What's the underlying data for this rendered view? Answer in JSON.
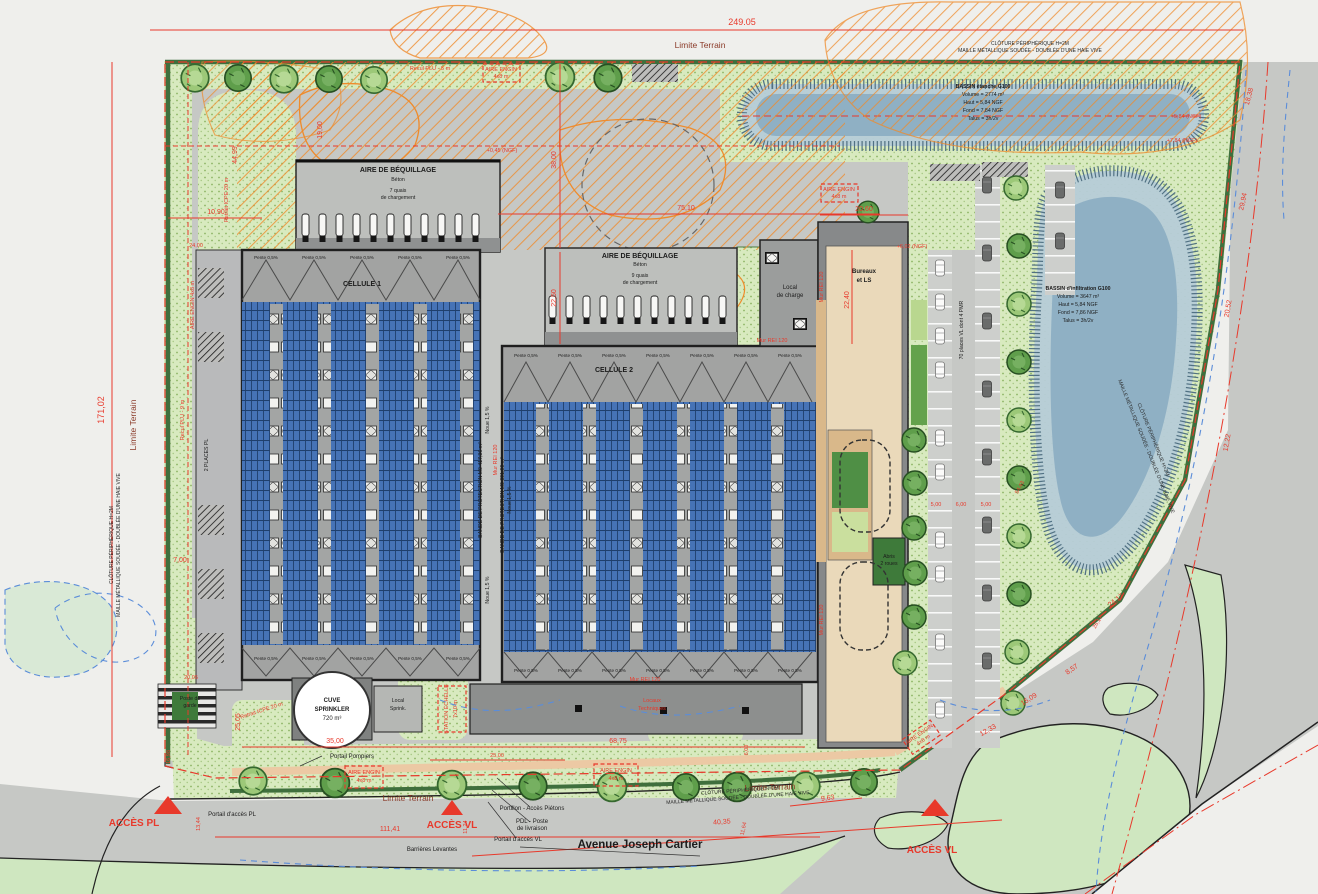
{
  "title": "Plan de masse - Avenue Joseph Cartier",
  "colors": {
    "dim_red": "#e8392b",
    "panel_blue": "#4673b6",
    "landscape_green": "#d8eabf",
    "hedge_green": "#3f6f3d",
    "water_blue": "#8fb0c4",
    "hatch_orange": "#ef8b2b",
    "road_gray": "#c6c8c5"
  },
  "labels": {
    "limite": "Limite Terrain",
    "cloture1": "CLÔTURE PÉRIPHÉRIQUE H=2M",
    "cloture2": "MAILLE MÉTALLIQUE SOUDÉE - DOUBLÉE D'UNE HAIE VIVE",
    "recul5": "Recul PLU - 5 m",
    "recul9": "Recul PLU - 9 m",
    "retrait": "Retrait ICPE 20 m",
    "aire_beq": "AIRE DE BÉQUILLAGE",
    "beton": "Béton",
    "quais7": "7 quais",
    "quais9": "9 quais",
    "charg": "de chargement",
    "cellule1": "CELLULE 1",
    "cellule2": "CELLULE 2",
    "pente": "Pente 0,5%",
    "noue": "Noue 1,5 %",
    "bande1": "BANDE DE PROTECTION M0 417,36 m²",
    "bande2": "BANDE DE PROTECTION M0 391,00 m²",
    "mur": "Mur REI 120",
    "lc1": "Local",
    "lc2": "de charge",
    "b1": "Bureaux",
    "b2": "et LS",
    "places70": "70 places VL dont 4 PMR",
    "places_pl": "2 PLACES PL",
    "ab1": "Abris",
    "ab2": "2 roues",
    "engin1": "AIRE ENGIN",
    "engin2": "4x8 m",
    "engin_v": "AIRE ENGIN 4x8 m",
    "cuve1": "CUVE",
    "cuve2": "SPRINKLER",
    "cuve3": "720 m³",
    "sprink1": "Local",
    "sprink2": "Sprink.",
    "station1": "STATION ÉCHELLE",
    "station2": "7x10 m",
    "locaux1": "Locaux",
    "locaux2": "Techniques",
    "p_pompiers": "Portail Pompiers",
    "p_pl": "Portail d'accès PL",
    "p_vl": "Portail d'accès VL",
    "portillon": "Portillon - Accès Piétons",
    "pdl1": "PDL - Poste",
    "pdl2": "de livraison",
    "barrieres": "Barrières Levantes",
    "garde1": "Poste de",
    "garde2": "garde",
    "acces_pl": "ACCÈS PL",
    "acces_vl": "ACCÈS VL",
    "avenue": "Avenue Joseph Cartier",
    "ngf045": "+0,45 (NGF)",
    "ngf584": "+5,84 (NGF)",
    "ngf784": "+7,84 (NGF)",
    "ngf602": "+6,02 (NGF)"
  },
  "bassins": {
    "top": {
      "title": "BASSIN étanche G100",
      "lines": [
        "Volume = 2774 m³",
        "Haut = 5,84 NGF",
        "Fond = 7,84 NGF",
        "Talus = 3h/2v"
      ]
    },
    "right": {
      "title": "BASSIN d'infiltration G100",
      "lines": [
        "Volume = 3647 m³",
        "Haut = 5,84 NGF",
        "Fond = 7,86 NGF",
        "Talus = 3h/2v"
      ]
    }
  },
  "dims": {
    "d24905": "249.05",
    "d17102": "171,02",
    "d11141": "111,41",
    "d7510": "75,10",
    "d3800": "38,00",
    "d2060": "20,60",
    "d1090": "10,90",
    "d2400": "24,00",
    "d4499": "44,99",
    "d1900": "19,00",
    "d2250": "22,50",
    "d2240": "22,40",
    "d700": "7,00",
    "d2505": "25,05",
    "d1698": "16,98",
    "d1344": "13,44",
    "d1124": "11,24",
    "d3500": "35,00",
    "d2500": "25,00",
    "d6875": "68,75",
    "d600": "6,00",
    "d963": "9,63",
    "d4035": "40,35",
    "d1164": "11,64",
    "d1222": "12,22",
    "d1838": "18,38",
    "d2994": "29,94",
    "d2052": "20,52",
    "d2417": "24,17",
    "d857": "8,57",
    "d1509": "15,09",
    "d1233": "12,33",
    "d5443": "54,43",
    "d2617": "26,17",
    "d500": "5,00",
    "d2005": "20,05"
  }
}
